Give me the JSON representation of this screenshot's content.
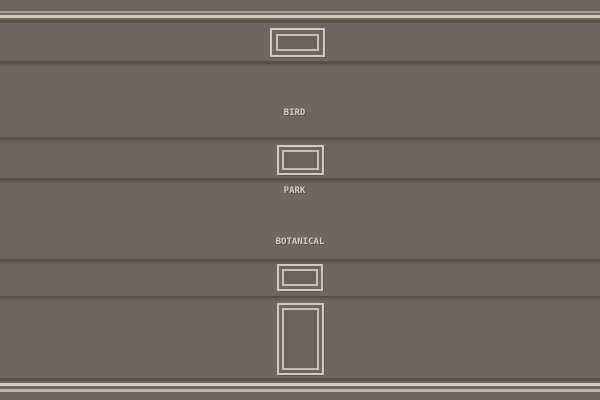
{
  "wall": {
    "plaques": [
      {
        "name": "bird-in-the-park",
        "lines": [
          "BIRD",
          "IN THE",
          "PARK"
        ]
      },
      {
        "name": "botanical-garden",
        "lines": [
          "BOTANICAL",
          "GARDEN"
        ]
      }
    ],
    "frames": [
      "picture-frame",
      "picture-frame",
      "picture-frame",
      "door-frame"
    ]
  },
  "colors": {
    "wall": "#6e6761",
    "wall_dark": "#6a635d",
    "molding_light": "#a49c91",
    "molding_cream": "#d3ccbe",
    "molding_soft": "#bdb5a9",
    "groove_dark": "#58514b",
    "groove_mid": "#665f59",
    "frame_border": "#d3ccbe",
    "frame_border_inner": "#c9c1b3",
    "plaque_text": "#d8d1c3"
  }
}
